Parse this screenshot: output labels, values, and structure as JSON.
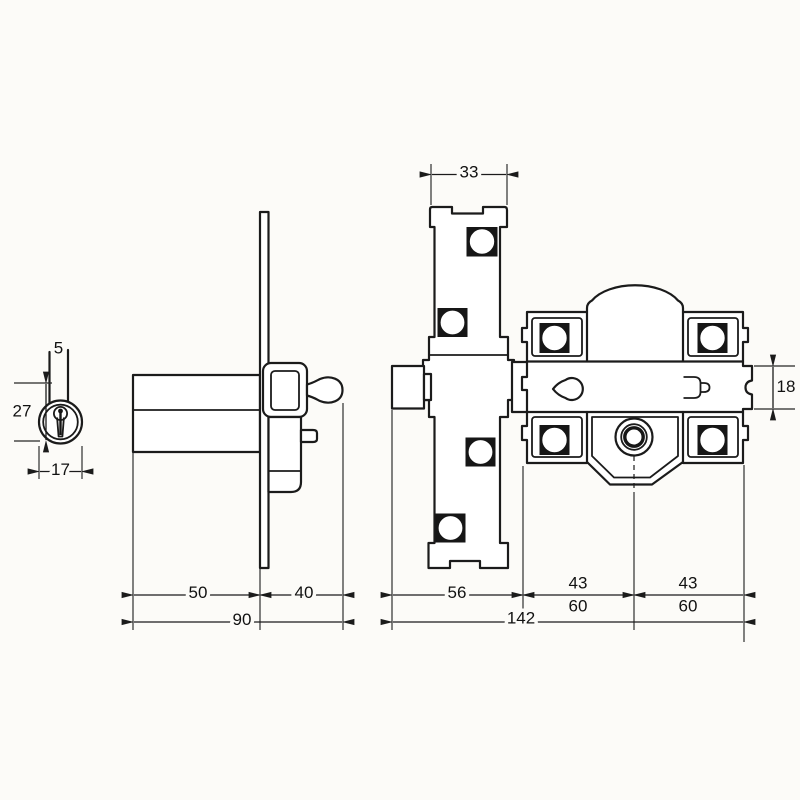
{
  "drawing": {
    "description_colors": {
      "line": "#1b1b1b",
      "paper": "#fcfbf8"
    },
    "views": {
      "cylinder_front": {
        "dims": {
          "stem_width": "5",
          "body_height": "27",
          "body_diameter": "17"
        }
      },
      "lock_side": {
        "dims": {
          "case_depth": "50",
          "knob_clearance": "40",
          "total_depth": "90"
        }
      },
      "lock_front": {
        "dims": {
          "strike_width": "33",
          "bolt_height": "18",
          "bolt_to_case": "56",
          "hole_span_left": "43",
          "hole_span_left_alt": "60",
          "hole_span_right": "43",
          "hole_span_right_alt": "60",
          "total_width": "142"
        }
      }
    }
  }
}
